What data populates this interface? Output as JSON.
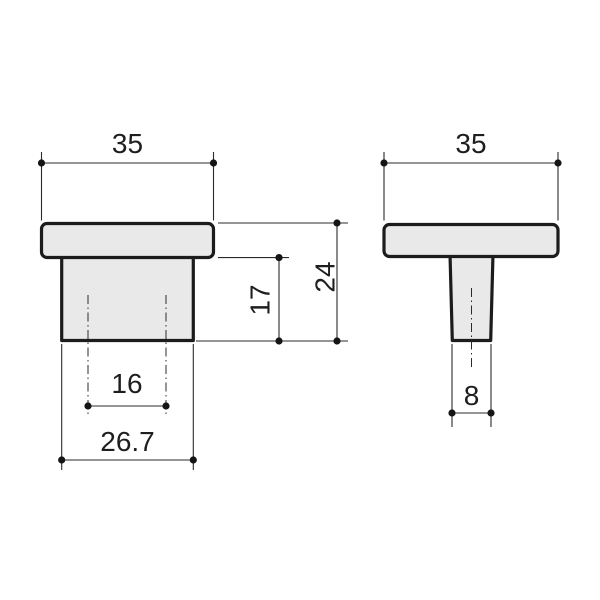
{
  "drawing": {
    "type": "technical-dimension-drawing",
    "colors": {
      "background": "#ffffff",
      "part_fill": "#e9e9e9",
      "part_outline": "#1c1c1c",
      "dimension_lines": "#2b2b2b",
      "dimension_text": "#1e1e1e"
    },
    "dimensions": {
      "front_view": {
        "cap_width": "35",
        "body_height": "17",
        "total_height": "24",
        "hole_spacing": "16",
        "base_width": "26.7"
      },
      "side_view": {
        "cap_width": "35",
        "stem_width": "8"
      }
    }
  }
}
